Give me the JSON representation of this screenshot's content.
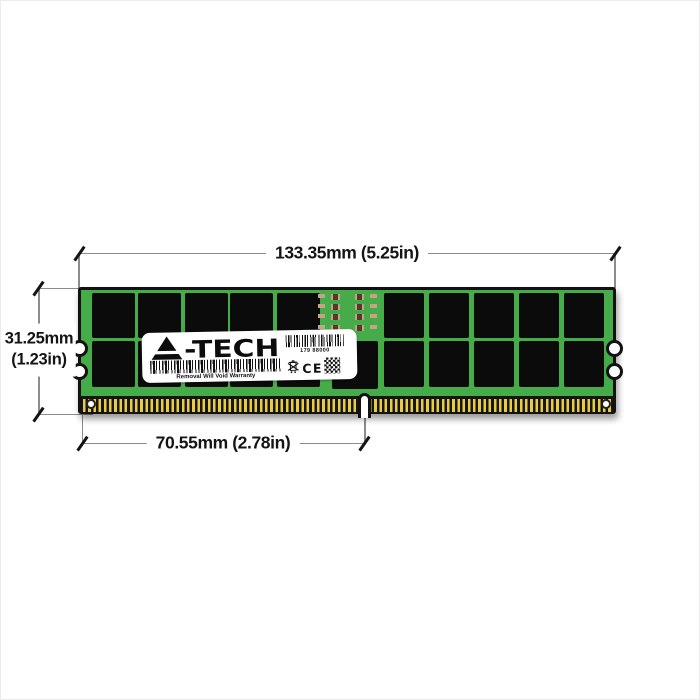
{
  "dimensions": {
    "width": "133.35mm (5.25in)",
    "height_line1": "31.25mm",
    "height_line2": "(1.23in)",
    "pin_width": "70.55mm (2.78in)"
  },
  "module": {
    "pcb_color": "#46ab49",
    "chip_color": "#0b0b0b",
    "pin_gold_color": "#e8cd3f",
    "pin_base_color": "#151515",
    "chip_counts": {
      "top_left": 5,
      "top_right": 5,
      "bottom_left": 5,
      "bottom_right": 5
    }
  },
  "label": {
    "brand": "A-TECH",
    "brand_suffix": "-TECH",
    "serial": "179 88000",
    "warranty": "Removal Will Void Warranty",
    "ce_mark": "CE"
  }
}
